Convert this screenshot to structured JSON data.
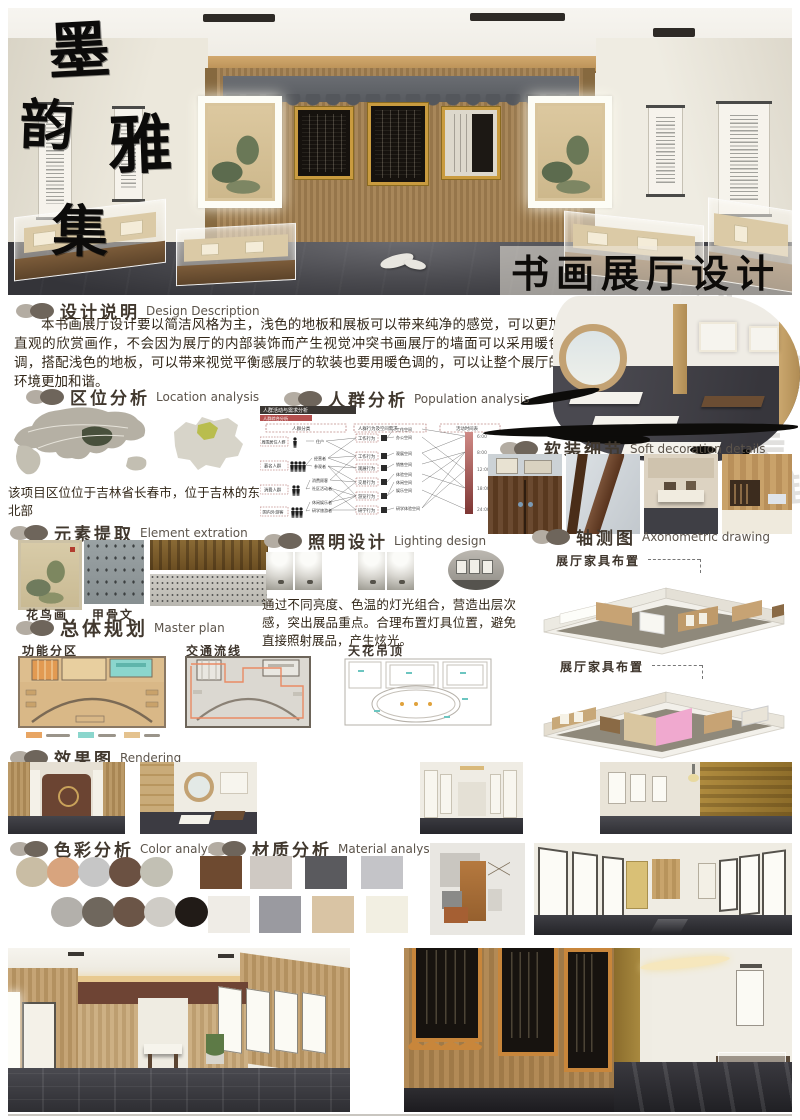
{
  "poster": {
    "vertical_title": [
      "墨",
      "韵",
      "雅",
      "集"
    ],
    "hero_caption": "书画展厅设计",
    "watermark_chars": [
      "老",
      "禮",
      "道",
      "美",
      "雅"
    ]
  },
  "sections": {
    "design_description": {
      "zh": "设计说明",
      "en": "Design Description",
      "body": "本书画展厅设计要以简洁风格为主，浅色的地板和展板可以带来纯净的感觉，可以更加直观的欣赏画作，不会因为展厅的内部装饰而产生视觉冲突书画展厅的墙面可以采用暖色调，搭配浅色的地板，可以带来视觉平衡感展厅的软装也要用暖色调的，可以让整个展厅的环境更加和谐。"
    },
    "location": {
      "zh": "区位分析",
      "en": "Location analysis",
      "note": "该项目区位位于吉林省长春市，位于吉林的东北部"
    },
    "population": {
      "zh": "人群分析",
      "en": "Population analysis",
      "diagram_title": "人群活动与需求分析",
      "diagram_subtitle": "人群综合分析",
      "col_headers": [
        "人群分类",
        "人群行为及空间需求",
        "活动时间表"
      ],
      "groups": [
        "周围居住人群",
        "慕名人群",
        "消费人群",
        "国内外游客"
      ],
      "mid_nodes": [
        "住户",
        "经营者",
        "参观者",
        "消费顾客",
        "社区活动者",
        "休闲娱乐者",
        "研学旅游者"
      ],
      "behaviors": [
        "工作行为",
        "工作行为",
        "观展行为",
        "交易行为",
        "游览行为",
        "研学行为"
      ],
      "spaces": [
        "工作空间",
        "办公空间",
        "观展空间",
        "销售空间",
        "体验空间",
        "休闲空间",
        "娱乐空间",
        "研学体验空间"
      ],
      "times": [
        "6:00",
        "8:00",
        "12:00",
        "18:00",
        "24:00"
      ]
    },
    "soft_decoration": {
      "zh": "软装细节",
      "en": "Soft decoration details"
    },
    "element_extraction": {
      "zh": "元素提取",
      "en": "Element extration",
      "labels": [
        "花鸟画",
        "甲骨文"
      ]
    },
    "lighting": {
      "zh": "照明设计",
      "en": "Lighting design",
      "body": "通过不同亮度、色温的灯光组合，营造出层次感，突出展品重点。合理布置灯具位置，避免直接照射展品，产生炫光。"
    },
    "axonometric": {
      "zh": "轴测图",
      "en": "Axonometric drawing",
      "labels": [
        "展厅家具布置",
        "展厅家具布置"
      ]
    },
    "master_plan": {
      "zh": "总体规划",
      "en": "Master plan",
      "plans": [
        "功能分区",
        "交通流线",
        "天花吊顶"
      ],
      "legend_colors": [
        "#e8a563",
        "#8bd6cd",
        "#e4c28e"
      ]
    },
    "rendering": {
      "zh": "效果图",
      "en": "Rendering"
    },
    "color_analysis": {
      "zh": "色彩分析",
      "en": "Color analysis",
      "row1": [
        "#c9bda4",
        "#d8a47e",
        "#c6c6c6",
        "#6b5142",
        "#c2c0b4"
      ],
      "row2": [
        "#b3b0ab",
        "#6f675d",
        "#6b5547",
        "#cfccc6",
        "#211b17"
      ]
    },
    "material_analysis": {
      "zh": "材质分析",
      "en": "Material analysis",
      "swatches": [
        "#6e4a30",
        "#cfc9c3",
        "#5a5a5e",
        "#c4c4c8",
        "#efece6",
        "#9a9aa0",
        "#d9c4a4",
        "#f2efe2"
      ]
    }
  }
}
